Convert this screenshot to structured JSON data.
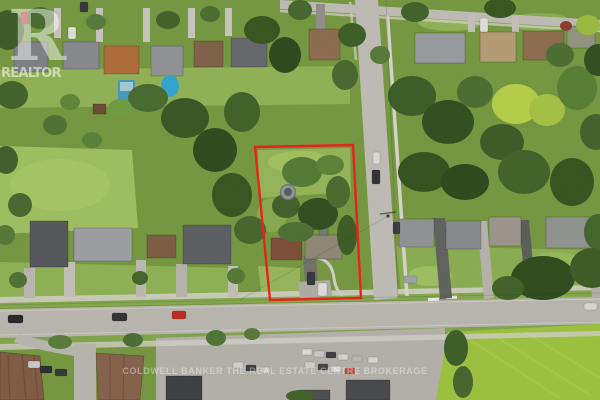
{
  "watermark": {
    "logo_initial": "R",
    "logo_word": "REALTOR",
    "brokerage": "COLDWELL BANKER THE REAL ESTATE CENTRE BROKERAGE"
  },
  "boundary": {
    "color": "#e8231d"
  },
  "colors": {
    "canopy_dark": "#2f4d1f",
    "lawn_bright": "#9dbd5f",
    "road_grey": "#b7b4ae",
    "field_green": "#9cbf3e",
    "pool_blue": "#2fa3cf",
    "watermark_white": "#ffffff"
  }
}
